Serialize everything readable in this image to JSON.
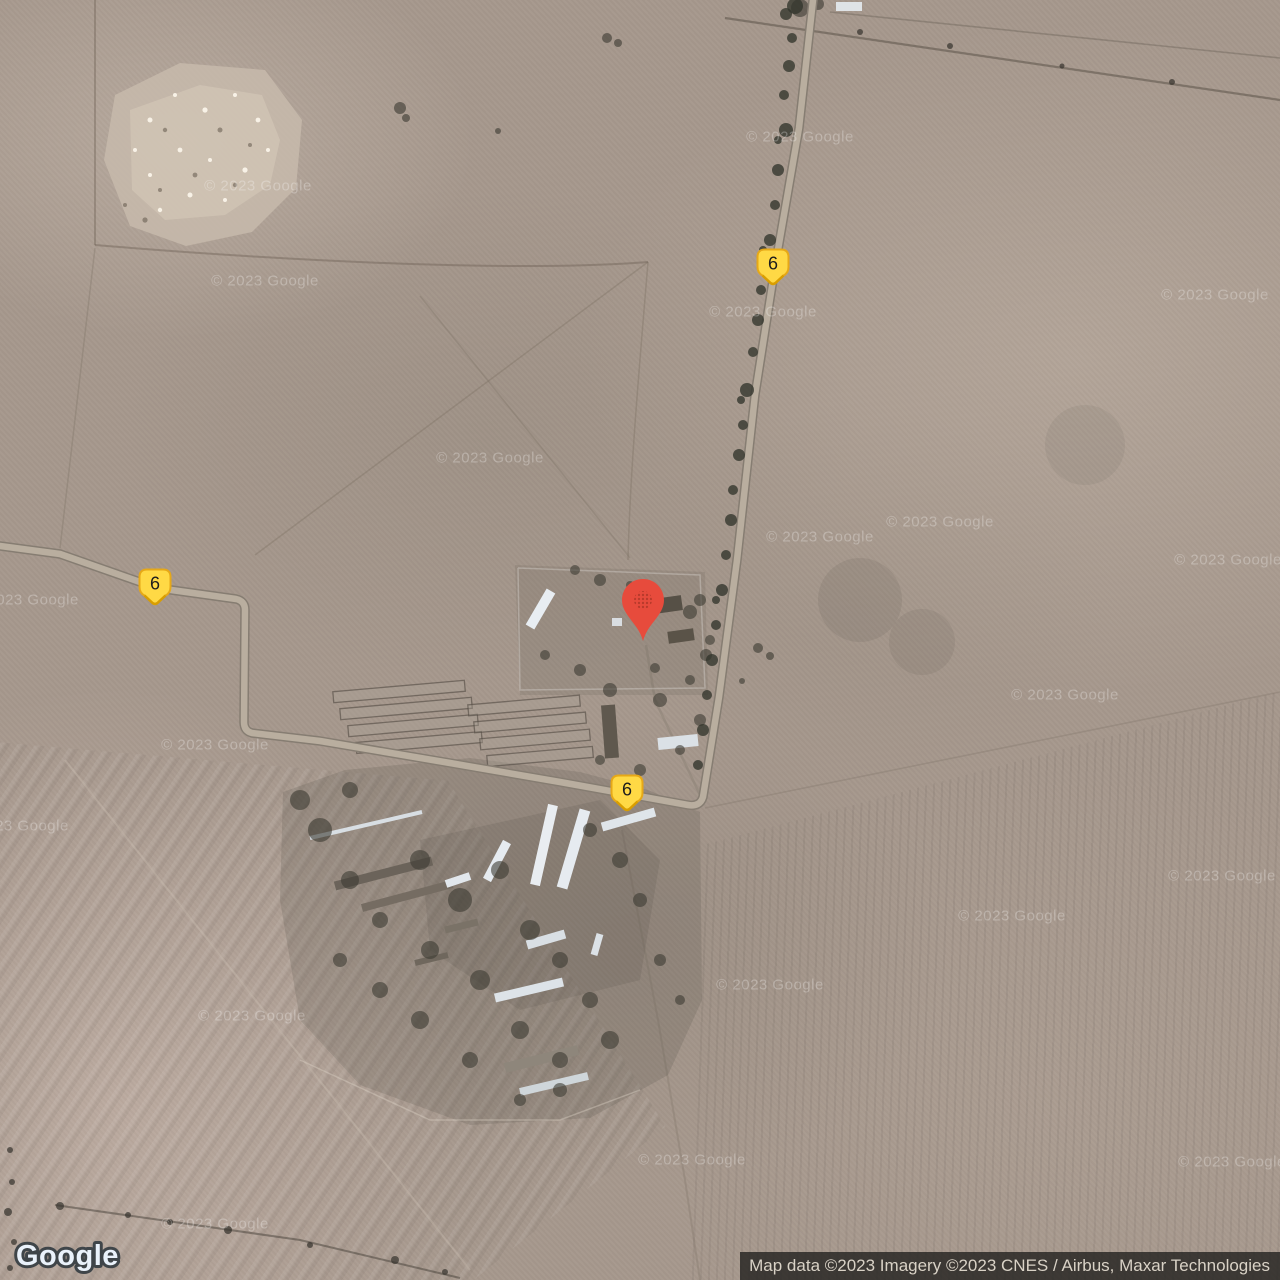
{
  "map": {
    "watermark_text": "© 2023 Google",
    "route_shield_label": "6",
    "colors": {
      "terrain_base": "#A6988D",
      "road_fill": "#B9AE9F",
      "road_casing": "#867D72",
      "shield_fill": "#FFD945",
      "shield_border": "#E6A817",
      "pin_red": "#E74B3C"
    }
  },
  "branding": {
    "logo_text": "Google"
  },
  "attribution": {
    "text": "Map data ©2023 Imagery ©2023 CNES / Airbus, Maxar Technologies"
  }
}
